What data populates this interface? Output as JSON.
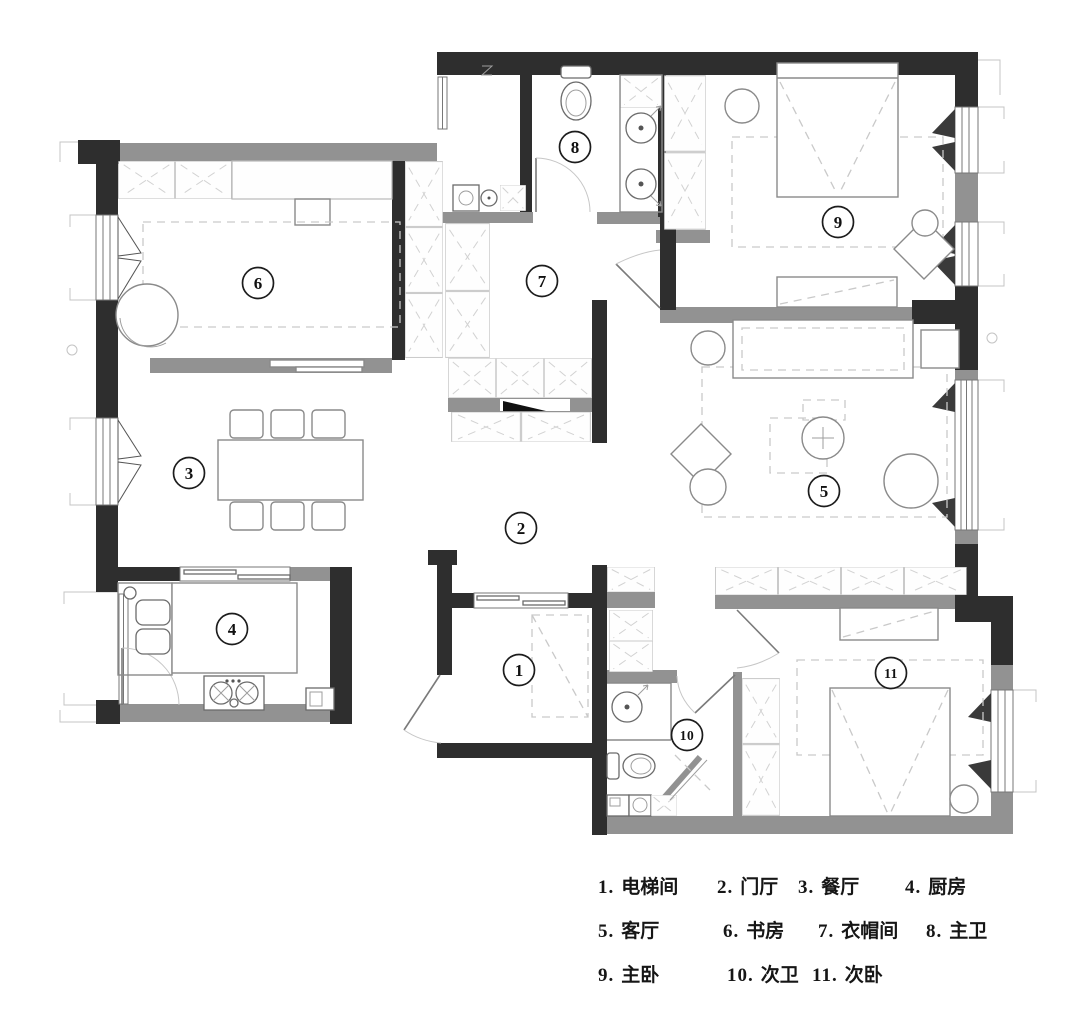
{
  "colors": {
    "wall": "#2e2e2e",
    "partition": "#929292",
    "dash": "#c9c9c9",
    "accent": "#111111"
  },
  "rooms": [
    {
      "number": "1",
      "name": "电梯间"
    },
    {
      "number": "2",
      "name": "门厅"
    },
    {
      "number": "3",
      "name": "餐厅"
    },
    {
      "number": "4",
      "name": "厨房"
    },
    {
      "number": "5",
      "name": "客厅"
    },
    {
      "number": "6",
      "name": "书房"
    },
    {
      "number": "7",
      "name": "衣帽间"
    },
    {
      "number": "8",
      "name": "主卫"
    },
    {
      "number": "9",
      "name": "主卧"
    },
    {
      "number": "10",
      "name": "次卫"
    },
    {
      "number": "11",
      "name": "次卧"
    }
  ],
  "legend": {
    "items": [
      {
        "num": "1.",
        "label": "电梯间"
      },
      {
        "num": "2.",
        "label": "门厅"
      },
      {
        "num": "3.",
        "label": "餐厅"
      },
      {
        "num": "4.",
        "label": "厨房"
      },
      {
        "num": "5.",
        "label": "客厅"
      },
      {
        "num": "6.",
        "label": "书房"
      },
      {
        "num": "7.",
        "label": "衣帽间"
      },
      {
        "num": "8.",
        "label": "主卫"
      },
      {
        "num": "9.",
        "label": "主卧"
      },
      {
        "num": "10.",
        "label": "次卫"
      },
      {
        "num": "11.",
        "label": "次卧"
      }
    ]
  }
}
